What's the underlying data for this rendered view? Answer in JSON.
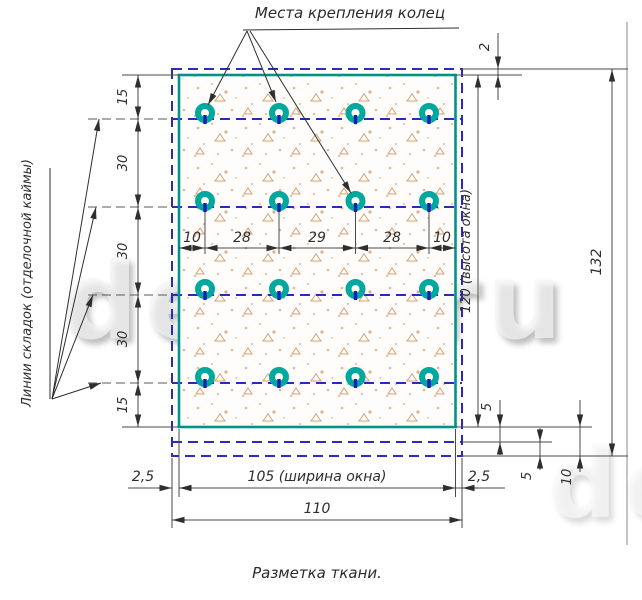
{
  "drawing": {
    "title": "Места крепления колец",
    "fold_lines_label": "Линии складок (отделочной каймы)",
    "caption": "Разметка ткани.",
    "watermark": "deek.ru"
  },
  "dims": {
    "top_edge": "2",
    "v_chain": [
      "15",
      "30",
      "30",
      "30",
      "15"
    ],
    "h_chain": [
      "10",
      "28",
      "29",
      "28",
      "10"
    ],
    "window_height": "120 (высота окна)",
    "total_height": "132",
    "hem_fold_1": "5",
    "hem_fold_2": "5",
    "hem_total": "10",
    "margin_left": "2,5",
    "margin_right": "2,5",
    "window_width": "105 (ширина окна)",
    "total_width": "110"
  },
  "grid": {
    "ring_rows": 4,
    "ring_cols": 4
  },
  "colors": {
    "window_outline": "#00938b",
    "fold_line_blue": "#2a2ac1",
    "ring_teal": "#00a89e",
    "ring_tick_navy": "#1a1ab8",
    "dimension_ink": "#2e2e2e",
    "speckle": "#e0a074"
  }
}
